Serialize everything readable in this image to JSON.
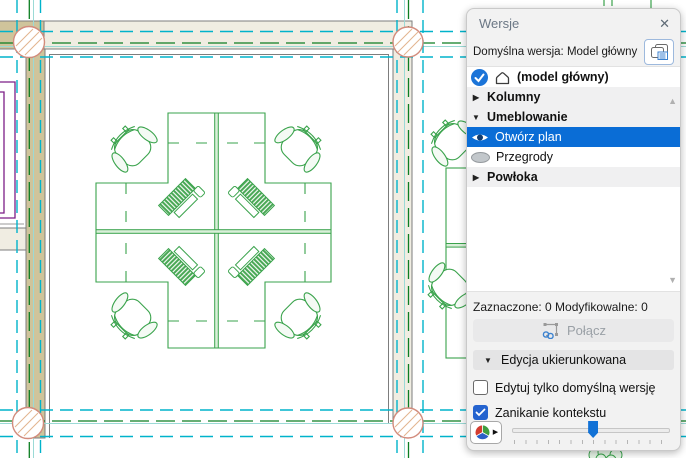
{
  "panel": {
    "title": "Wersje",
    "default_version_label": "Domyślna wersja: Model główny",
    "list": {
      "items": [
        {
          "label": "(model główny)",
          "type": "model-row",
          "checked": true
        },
        {
          "label": "Kolumny",
          "type": "category",
          "expanded": false
        },
        {
          "label": "Umeblowanie",
          "type": "category",
          "expanded": true
        },
        {
          "label": "Otwórz plan",
          "type": "option",
          "visibility": "visible",
          "selected": true
        },
        {
          "label": "Przegrody",
          "type": "option",
          "visibility": "hidden",
          "selected": false
        },
        {
          "label": "Powłoka",
          "type": "category",
          "expanded": false
        }
      ]
    },
    "status_label": "Zaznaczone: 0 Modyfikowalne: 0",
    "connect_label": "Połącz",
    "connect_enabled": false,
    "targeted_editing_label": "Edycja ukierunkowana",
    "checkboxes": [
      {
        "label": "Edytuj tylko domyślną wersję",
        "checked": false
      },
      {
        "label": "Zanikanie kontekstu",
        "checked": true
      }
    ],
    "slider": {
      "value_percent": 48
    },
    "icons": [
      "close-icon",
      "transfer-versions-icon",
      "checked-circle-icon",
      "model-icon",
      "eye-visible-icon",
      "eye-hidden-icon",
      "chain-link-icon",
      "color-wheel-icon",
      "scroll-up-icon",
      "scroll-down-icon"
    ],
    "colors": {
      "selection_blue": "#0a6dd6",
      "checkbox_blue": "#2463cf",
      "panel_bg": "#f2f2f2",
      "category_row_bg": "#f0f0f1"
    }
  },
  "canvas": {
    "description": "floor plan with four-desk workstation cluster, chairs, walls, structural grid",
    "colors": {
      "furniture_green": "#3aa34c",
      "grid_cyan_dashed": "#00b3cb",
      "grid_green_dashed": "#0c7e22",
      "grid_teal_solid": "#9bdad6",
      "wall_active_tan": "#cfc49b",
      "wall_faded_beige": "#f0ede2",
      "wall_outline_gray": "#7d7d7d",
      "column_outline_salmon": "#d28b7c",
      "window_purple": "#7c1e87"
    }
  }
}
